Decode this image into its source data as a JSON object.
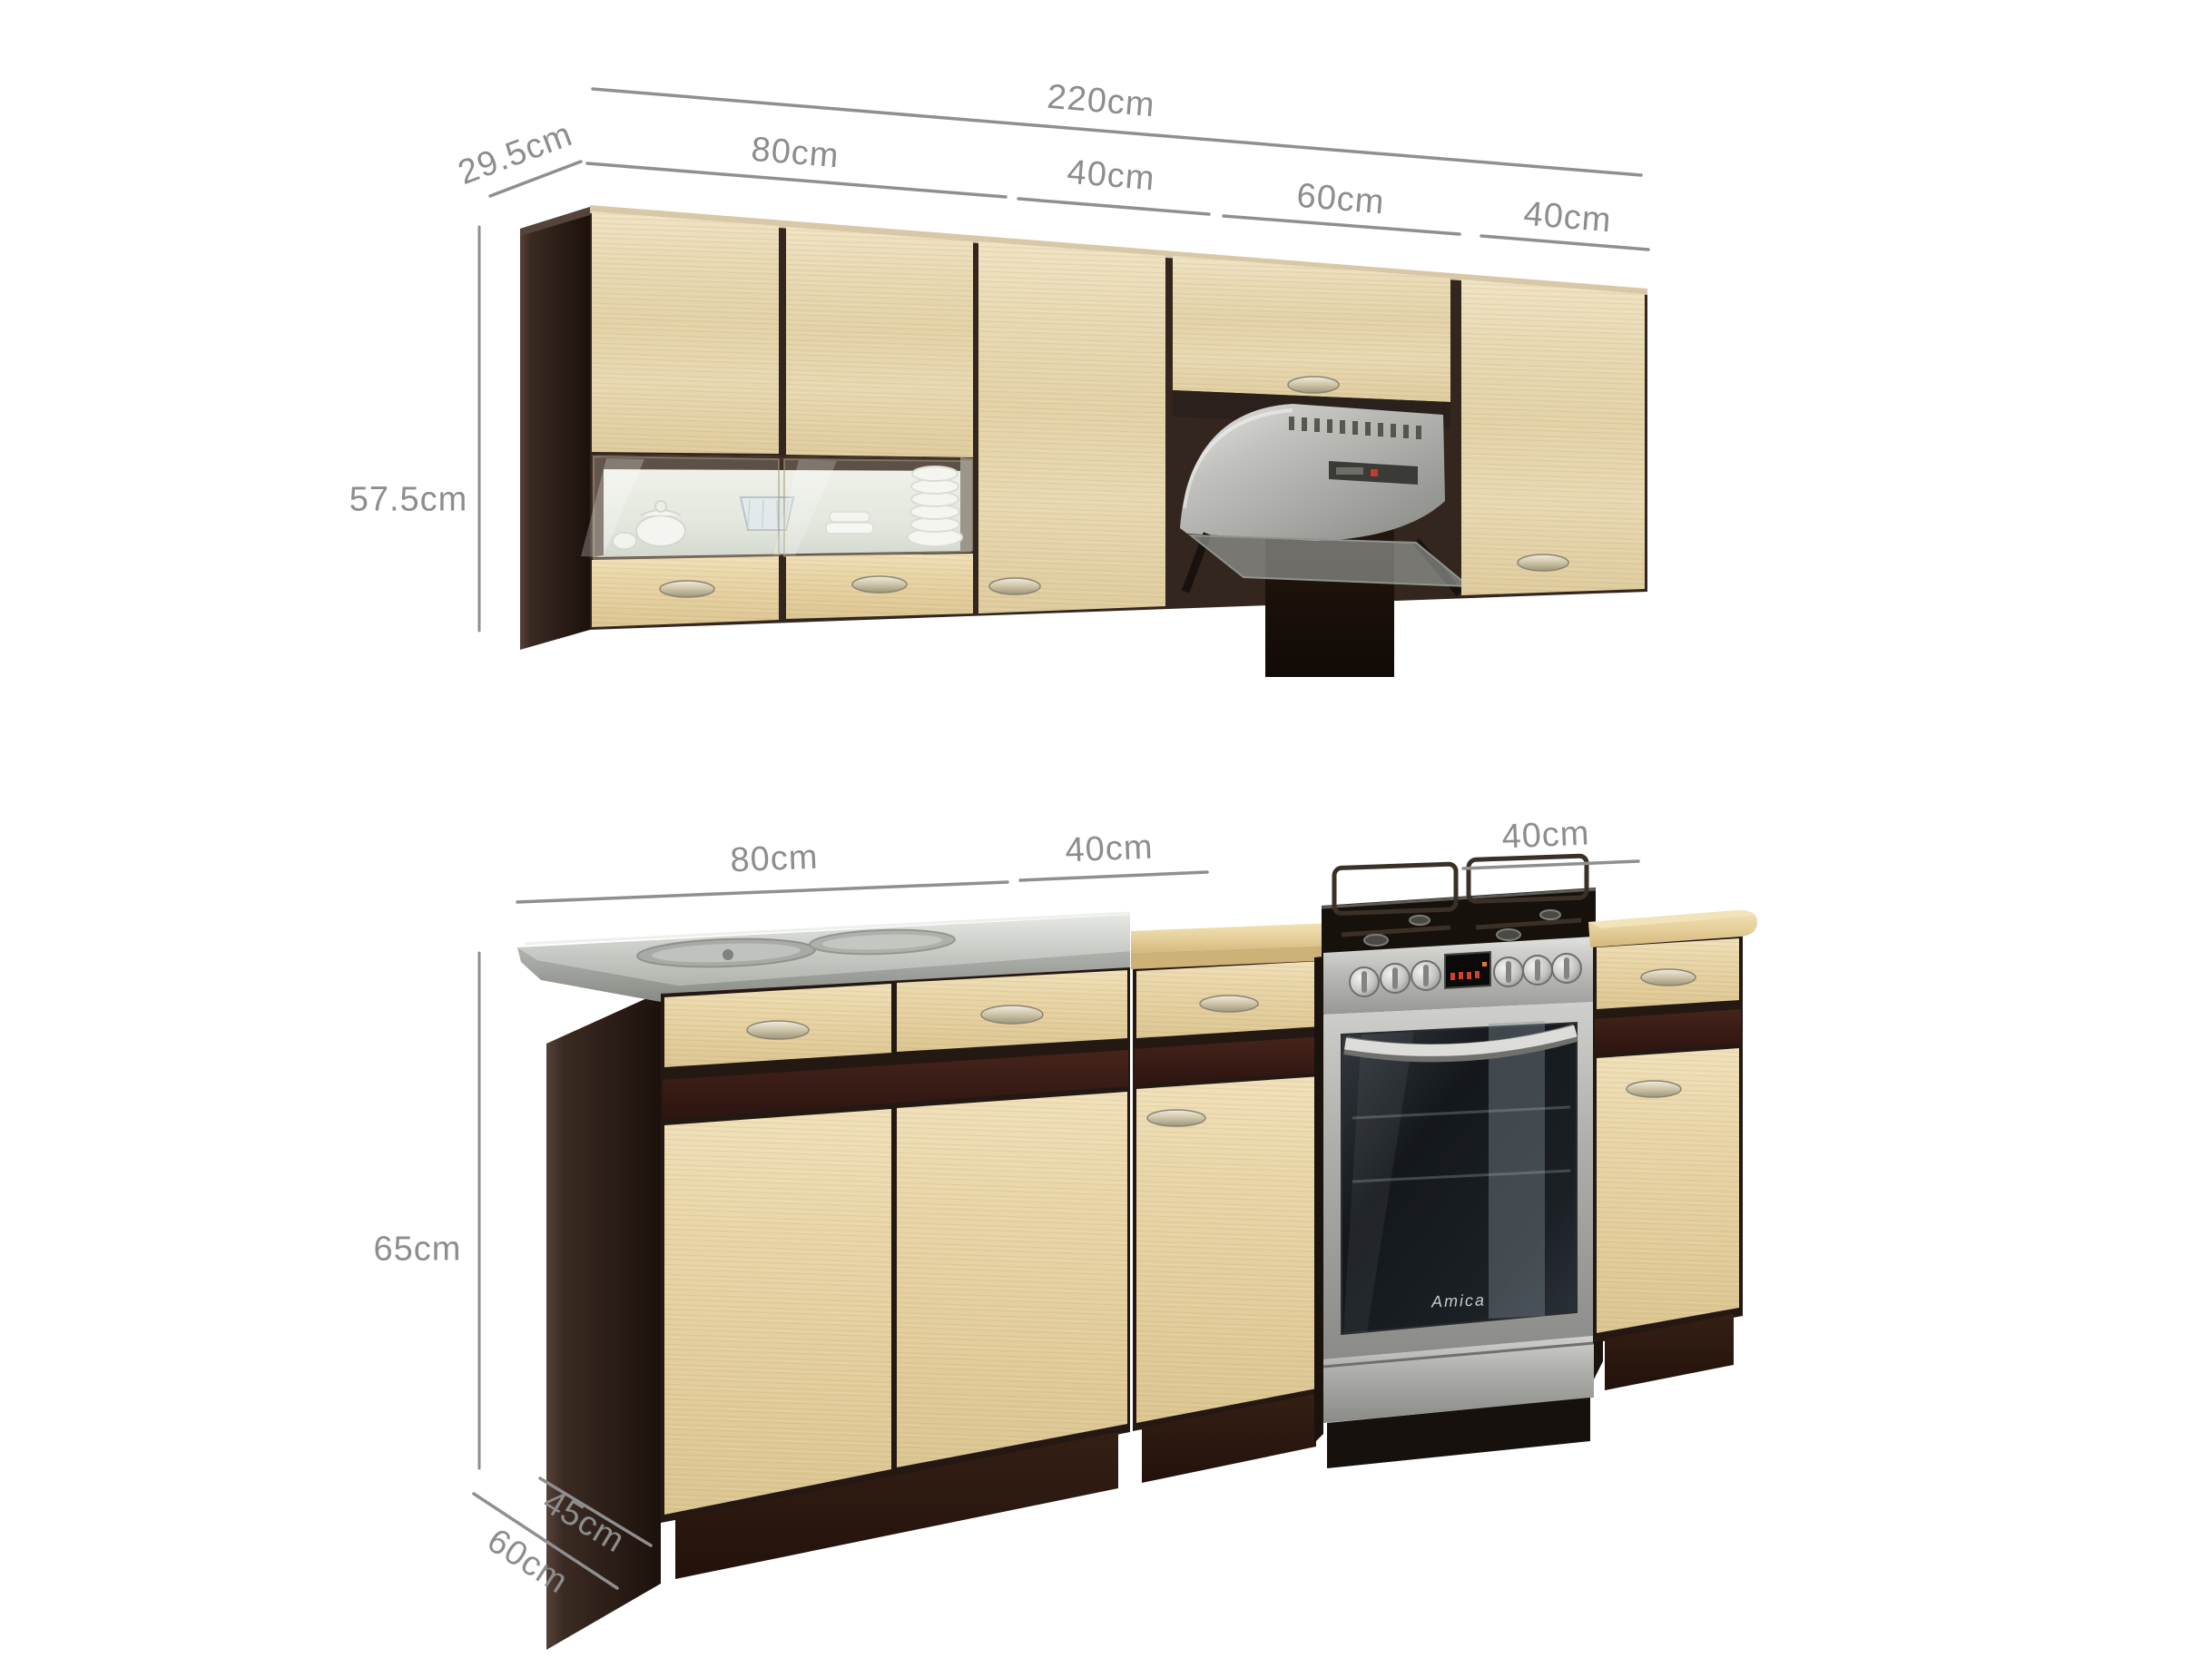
{
  "dims": {
    "wall": {
      "total_width": "220cm",
      "depth": "29.5cm",
      "height": "57.5cm",
      "sections": [
        "80cm",
        "40cm",
        "60cm",
        "40cm"
      ]
    },
    "base": {
      "height": "65cm",
      "depth_cabinet": "45cm",
      "depth_worktop": "60cm",
      "sections": [
        "80cm",
        "40cm",
        "40cm"
      ]
    }
  },
  "appliances": {
    "oven_brand": "Amica"
  },
  "colors": {
    "background": "#ffffff",
    "annotation": "#8d8d8d",
    "carcass_wenge": "#2c1e17",
    "door_wood_light": "#e9dab4",
    "accent_stripe": "#3a2017",
    "worktop_wood": "#e6d09c",
    "stainless_steel": "#b7b8b4",
    "oven_glass": "#14181c"
  }
}
